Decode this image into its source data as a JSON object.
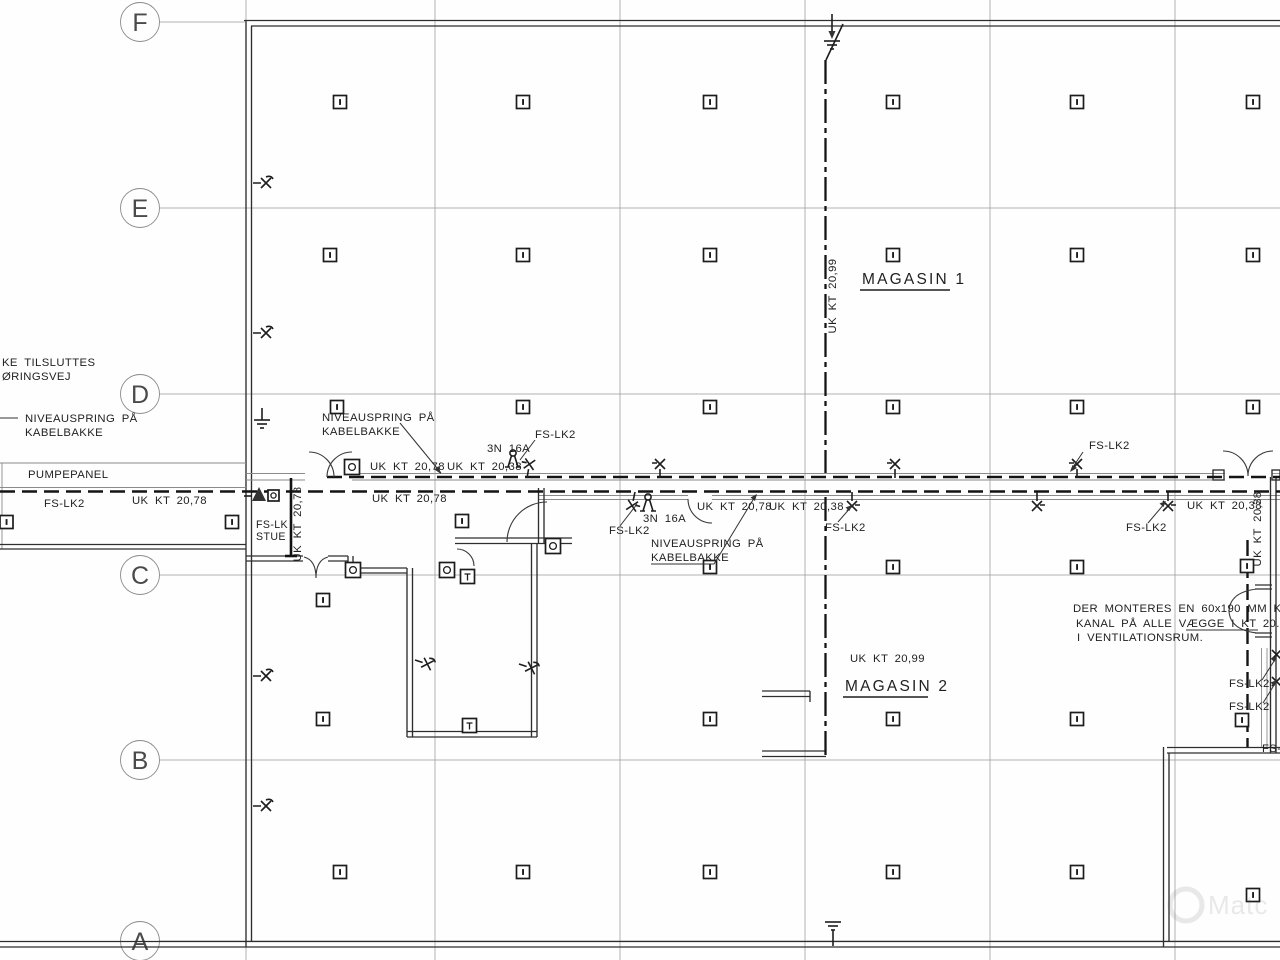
{
  "grid": {
    "rows": [
      "F",
      "E",
      "D",
      "C",
      "B",
      "A"
    ]
  },
  "rooms": {
    "magasin1": "MAGASIN 1",
    "magasin2": "MAGASIN 2"
  },
  "labels": {
    "pumpepanel": "PUMPEPANEL",
    "fs_lk2": "FS-LK2",
    "fs_lk_stue_line1": "FS-LK",
    "fs_lk_stue_line2": "STUE",
    "uk_kt_2078": "UK KT 20,78",
    "uk_kt_2038": "UK KT 20,38",
    "uk_kt_2099": "UK KT 20,99",
    "breaker_3n16a": "3N 16A",
    "niveauspring_line1": "NIVEAUSPRING PÅ",
    "niveauspring_line2": "KABELBAKKE",
    "edge_cut_line1": "KE TILSLUTTES",
    "edge_cut_line2": "ØRINGSVEJ",
    "note_line1": "DER MONTERES EN 60x190 MM KABEL-",
    "note_line2": "KANAL PÅ ALLE VÆGGE I KT 20.38",
    "note_line3": "I VENTILATIONSRUM.",
    "watermark": "Matc"
  },
  "symbols": {
    "lighting_box_icon": "square-with-bar",
    "socket_box_icon": "square-with-circle",
    "t_box_icon": "square-with-T",
    "wall_fixture_icon": "x-with-stem",
    "lamp_icon": "circle-with-legs",
    "earth_icon": "ground-bars",
    "cable_tray": "heavy-dash-line"
  }
}
